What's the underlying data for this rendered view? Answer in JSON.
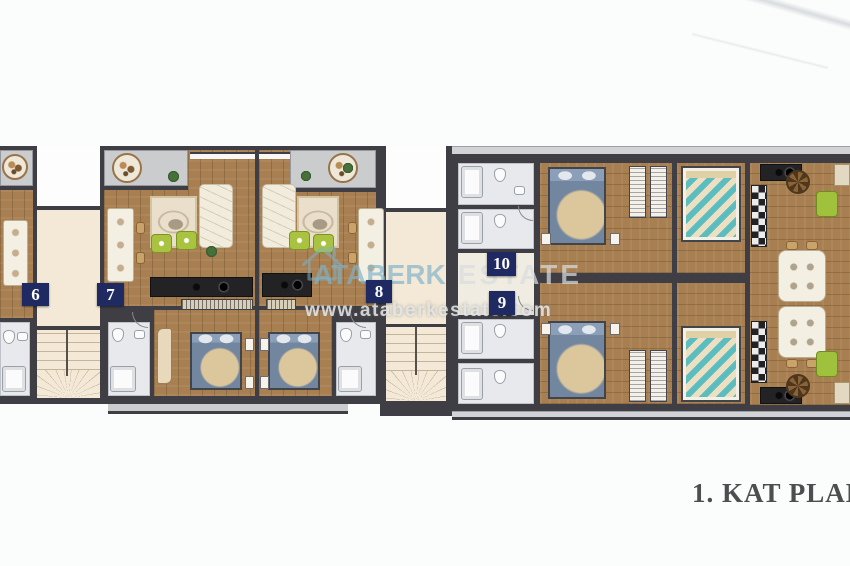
{
  "caption": {
    "text": "1. KAT PLANI"
  },
  "watermark": {
    "brand_primary": "ATABERK",
    "brand_secondary": "ESTATE",
    "url": "www.ataberkestate.com",
    "logo_icon": "house-outline-icon"
  },
  "units": [
    {
      "number": "6"
    },
    {
      "number": "7"
    },
    {
      "number": "8"
    },
    {
      "number": "9"
    },
    {
      "number": "10"
    }
  ],
  "palette": {
    "wall": "#3e3e44",
    "wood": "#a87f51",
    "balcony": "#cbccce",
    "shaft": "#f3e9d6",
    "tile": "#e7e9ec",
    "label-bg": "#1f2a63",
    "label-text": "#ffffff",
    "wm-blue": "#7db2cb",
    "wm-gray": "#d8dcde",
    "caption-color": "#4e4e50",
    "bed-blue": "#72879f",
    "bed-teal": "#5bbdbf",
    "pouf-green": "#a9c240",
    "counter-dark": "#232326"
  }
}
